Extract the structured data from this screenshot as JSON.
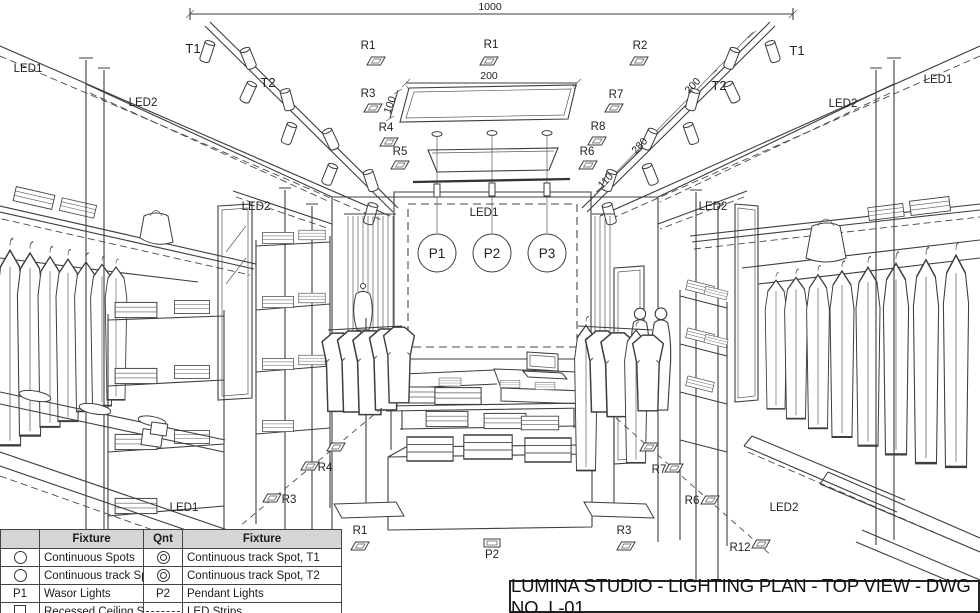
{
  "title_block": {
    "text": "LUMINA STUDIO - LIGHTING PLAN - TOP VIEW - DWG NO. L-01"
  },
  "legend": {
    "headers": [
      "",
      "Fixture",
      "Qnt",
      "Fixture"
    ],
    "rows": [
      {
        "s1": "circle",
        "f1": "Continuous Spots",
        "s2": "double-circle",
        "f2": "Continuous track Spot, T1"
      },
      {
        "s1": "circle",
        "f1": "Continuous track Spots",
        "s2": "double-circle",
        "f2": "Continuous track Spot, T2"
      },
      {
        "s1": "P1",
        "f1": "Wasor Lights",
        "s2": "P2",
        "f2": "Pendant Lights"
      },
      {
        "s1": "square",
        "f1": "Recessed Ceiling Spot",
        "s2": "dashes",
        "f2": "LED Strips"
      }
    ]
  },
  "dimensions": [
    {
      "text": "1000",
      "x": 490,
      "y": 10,
      "rotate": 0
    },
    {
      "text": "200",
      "x": 489,
      "y": 79,
      "rotate": 0
    },
    {
      "text": "100",
      "x": 393,
      "y": 106,
      "rotate": -70
    },
    {
      "text": "200",
      "x": 695,
      "y": 88,
      "rotate": -47
    },
    {
      "text": "280",
      "x": 642,
      "y": 148,
      "rotate": -47
    },
    {
      "text": "110",
      "x": 608,
      "y": 183,
      "rotate": -47
    }
  ],
  "callouts": [
    {
      "text": "LED1",
      "x": 28,
      "y": 72
    },
    {
      "text": "LED2",
      "x": 143,
      "y": 106
    },
    {
      "text": "T1",
      "x": 193,
      "y": 53,
      "big": true
    },
    {
      "text": "T2",
      "x": 268,
      "y": 87,
      "big": true
    },
    {
      "text": "R1",
      "x": 368,
      "y": 49,
      "spot": [
        376,
        61
      ]
    },
    {
      "text": "R1",
      "x": 491,
      "y": 48,
      "spot": [
        489,
        61
      ]
    },
    {
      "text": "R2",
      "x": 640,
      "y": 49,
      "spot": [
        639,
        61
      ]
    },
    {
      "text": "R3",
      "x": 368,
      "y": 97,
      "spot": [
        373,
        108
      ]
    },
    {
      "text": "R7",
      "x": 616,
      "y": 98,
      "spot": [
        614,
        108
      ]
    },
    {
      "text": "R4",
      "x": 386,
      "y": 131,
      "spot": [
        389,
        142
      ]
    },
    {
      "text": "R8",
      "x": 598,
      "y": 130,
      "spot": [
        597,
        141
      ]
    },
    {
      "text": "R5",
      "x": 400,
      "y": 155,
      "spot": [
        400,
        165
      ]
    },
    {
      "text": "R6",
      "x": 587,
      "y": 155,
      "spot": [
        588,
        165
      ]
    },
    {
      "text": "T2",
      "x": 719,
      "y": 90,
      "big": true
    },
    {
      "text": "T1",
      "x": 797,
      "y": 55,
      "big": true
    },
    {
      "text": "LED2",
      "x": 843,
      "y": 107
    },
    {
      "text": "LED1",
      "x": 938,
      "y": 83
    },
    {
      "text": "LED2",
      "x": 256,
      "y": 210
    },
    {
      "text": "LED1",
      "x": 484,
      "y": 216
    },
    {
      "text": "LED2",
      "x": 713,
      "y": 210
    },
    {
      "text": "LED1",
      "x": 184,
      "y": 511
    },
    {
      "text": "R4",
      "x": 325,
      "y": 471,
      "spot": [
        310,
        466
      ]
    },
    {
      "text": "R3",
      "x": 289,
      "y": 503,
      "spot": [
        272,
        498
      ]
    },
    {
      "text": "R1",
      "x": 360,
      "y": 534,
      "spot": [
        360,
        546
      ]
    },
    {
      "text": "P2",
      "x": 492,
      "y": 558,
      "prect": [
        492,
        543
      ]
    },
    {
      "text": "R3",
      "x": 624,
      "y": 534,
      "spot": [
        626,
        546
      ]
    },
    {
      "text": "R7",
      "x": 659,
      "y": 473,
      "spot": [
        674,
        468
      ]
    },
    {
      "text": "R6",
      "x": 692,
      "y": 504,
      "spot": [
        710,
        500
      ]
    },
    {
      "text": "R12",
      "x": 740,
      "y": 551,
      "spot": [
        761,
        544
      ]
    },
    {
      "text": "LED2",
      "x": 784,
      "y": 511
    }
  ],
  "floor_spots_unlabeled": [
    [
      336,
      447
    ],
    [
      649,
      447
    ]
  ],
  "pendants": [
    {
      "label": "P1",
      "x": 437
    },
    {
      "label": "P2",
      "x": 492
    },
    {
      "label": "P3",
      "x": 547
    }
  ],
  "pendant_y": 253,
  "colors": {
    "line": "#3d3d3d",
    "header_bg": "#d5d5d5",
    "paper": "#ffffff"
  }
}
